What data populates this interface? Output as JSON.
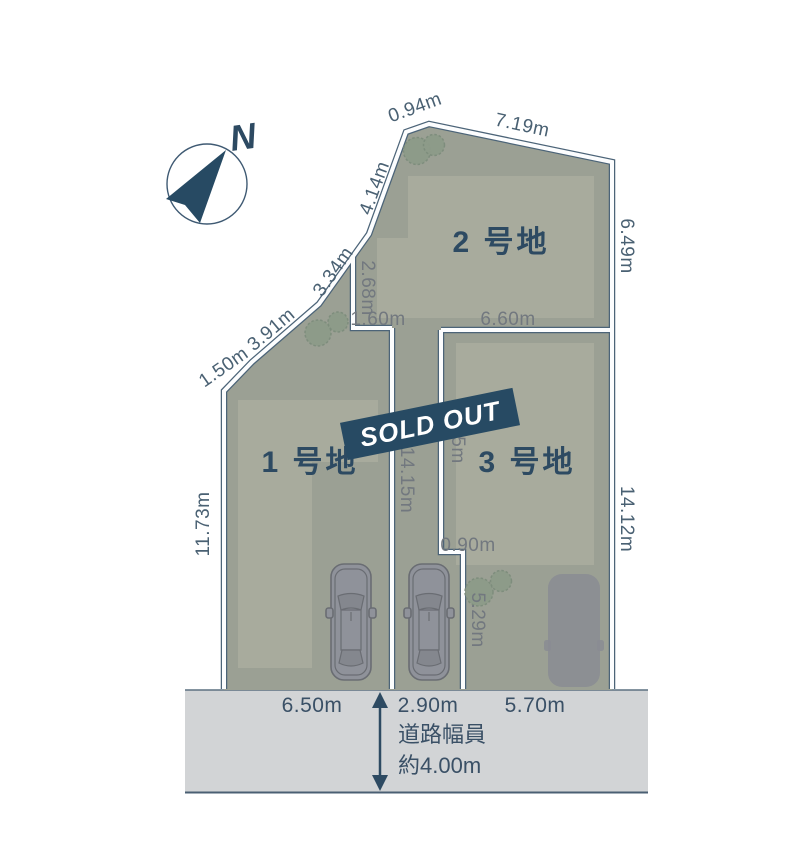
{
  "compass": {
    "label": "N"
  },
  "banner": {
    "text": "SOLD OUT"
  },
  "lots": {
    "lot1": {
      "label": "1 号地"
    },
    "lot2": {
      "label": "2 号地"
    },
    "lot3": {
      "label": "3 号地"
    }
  },
  "dimensions": {
    "d094": "0.94m",
    "d719": "7.19m",
    "d414": "4.14m",
    "d334": "3.34m",
    "d391": "3.91m",
    "d150": "1.50m",
    "d1173": "11.73m",
    "d649": "6.49m",
    "d268": "2.68m",
    "d160": "1.60m",
    "d660": "6.60m",
    "d1415": "14.15m",
    "d885": "8.85m",
    "d1412": "14.12m",
    "d090": "0.90m",
    "d529": "5.29m",
    "d650": "6.50m",
    "d290": "2.90m",
    "d570": "5.70m"
  },
  "road": {
    "caption_line1": "道路幅員",
    "caption_line2": "約4.00m"
  },
  "colors": {
    "navy": "#2d4a62",
    "boundary": "#4c6478",
    "lot_fill": "#9ba094",
    "building_fill": "#a8ab9d",
    "road_fill": "#d2d4d6",
    "dim_outer": "#4a6173",
    "dim_inner": "#72787f",
    "road_text": "#3a5066",
    "banner_bg": "#274a63",
    "banner_text": "#ffffff",
    "tree_fill": "#8d9b89",
    "car_fill": "#8f929a",
    "pad_fill": "#898c93",
    "white_line": "#fcfdfe"
  }
}
